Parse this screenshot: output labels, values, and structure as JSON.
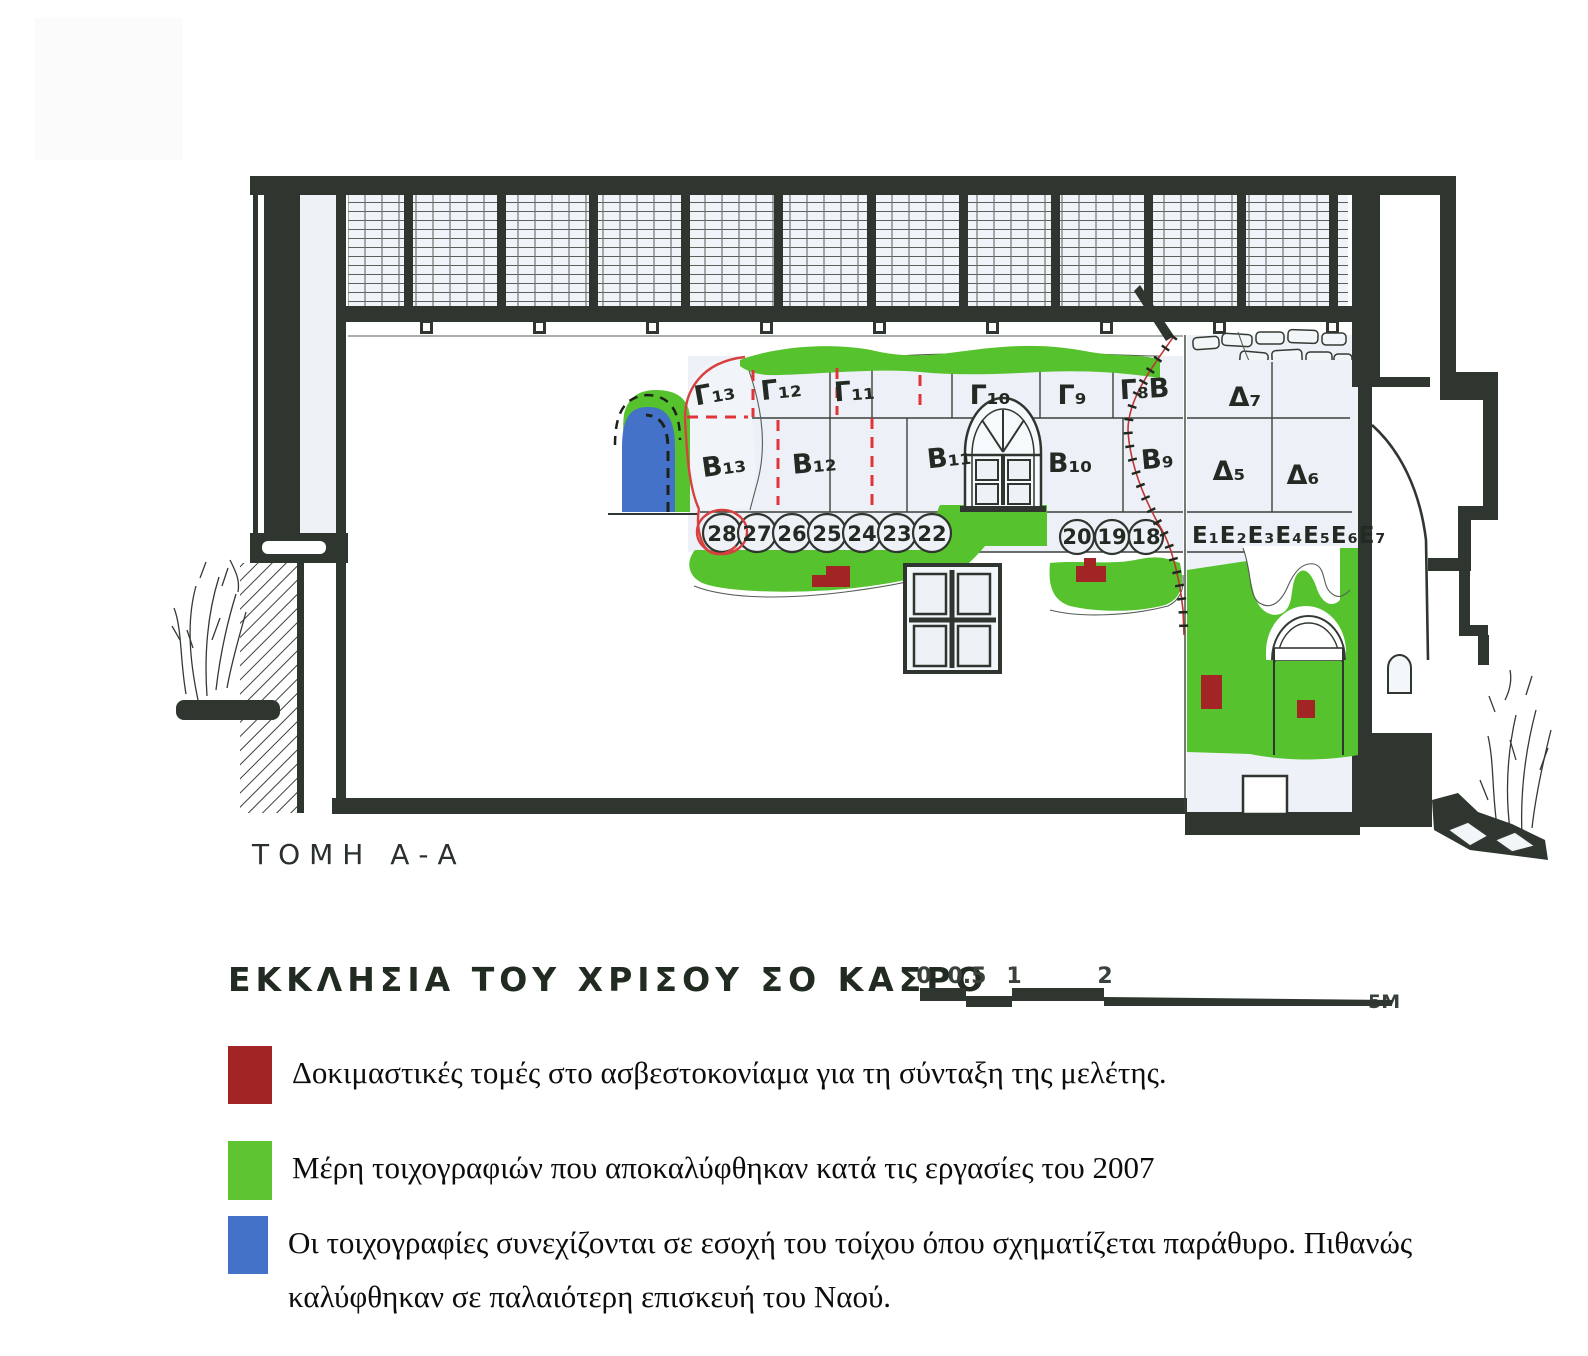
{
  "drawing": {
    "section_label": "ΤΟΜΗ Α-Α",
    "title": "ΕΚΚΛΗΣΙΑ ΤΟΥ ΧΡΙΣΟΥ ΣΟ ΚΑΣΡΟ",
    "gamma_row": [
      "Γ₁₃",
      "Γ₁₂",
      "Γ₁₁",
      "Γ₁₀",
      "Γ₉",
      "Γ₈Β",
      "Δ₇"
    ],
    "beta_row": [
      "Β₁₃",
      "Β₁₂",
      "Β₁₁",
      "Β₁₀",
      "Β₉",
      "Δ₅",
      "Δ₆"
    ],
    "circle_numbers": [
      "28",
      "27",
      "26",
      "25",
      "24",
      "23",
      "22",
      "20",
      "19",
      "18"
    ],
    "epsilon_row": "Ε₁Ε₂Ε₃Ε₄Ε₅Ε₆Ε₇",
    "scale_bar": {
      "tick0": "0",
      "tick05": "0.5",
      "tick1": "1",
      "tick2": "2",
      "end": "5M"
    }
  },
  "legend": {
    "red_label": "Δοκιμαστικές τομές στο ασβεστοκονίαμα για τη σύνταξη της μελέτης.",
    "green_label": "Μέρη τοιχογραφιών που αποκαλύφθηκαν κατά τις εργασίες του 2007",
    "blue_label": "Οι τοιχογραφίες συνεχίζονται σε εσοχή του τοίχου όπου σχηματίζεται παράθυρο. Πιθανώς καλύφθηκαν σε παλαιότερη επισκευή του Ναού."
  },
  "colors": {
    "green": "#56c22d",
    "dark_red": "#a22424",
    "bright_red": "#e03438",
    "blue": "#4472c8",
    "ink": "#2f362f"
  }
}
